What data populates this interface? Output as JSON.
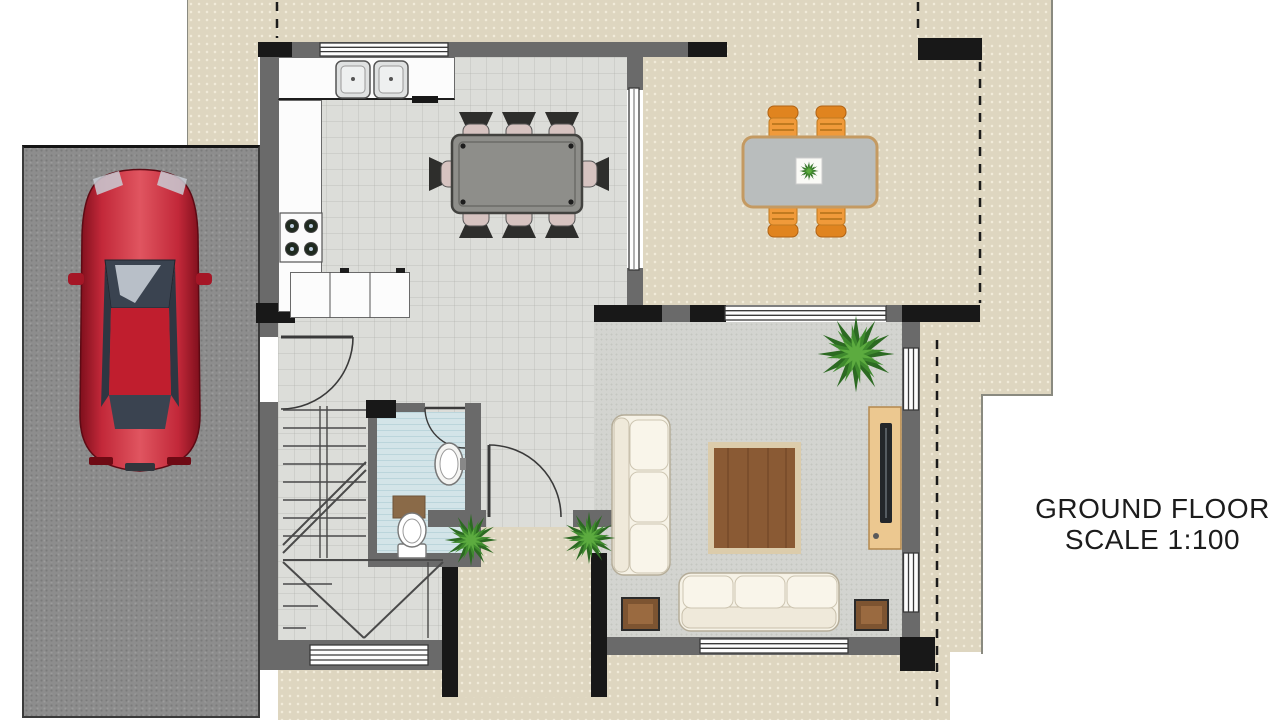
{
  "annotation": {
    "title": "GROUND FLOOR",
    "scale_label": "SCALE 1:100"
  },
  "legend_colors": {
    "patio_paving": "#ded6c0",
    "interior_tile": "#dcddd9",
    "living_floor": "#d3d4d0",
    "bathroom_floor": "#d3e4e8",
    "driveway_asphalt": "#8d8d8d",
    "wall_gray": "#6a6a6a",
    "wall_black": "#181818",
    "car_red": "#c22030",
    "outdoor_chair_orange": "#f09a3a",
    "dining_table_gray": "#8e8e8a",
    "rug_brown": "#8a5a34",
    "sofa_cream": "#f5f1e6",
    "plant_green": "#3f8a2e",
    "wood_furniture": "#7d5431"
  },
  "elements": [
    "driveway-with-red-car",
    "kitchen-double-sink-stove-cabinets",
    "dining-table-8-chairs",
    "patio-table-4-orange-chairs",
    "living-room-two-sofas-rug-tv-console",
    "staircase",
    "bathroom-toilet-sink",
    "entry-porch-two-plants",
    "property-boundary-dashed-lines"
  ]
}
